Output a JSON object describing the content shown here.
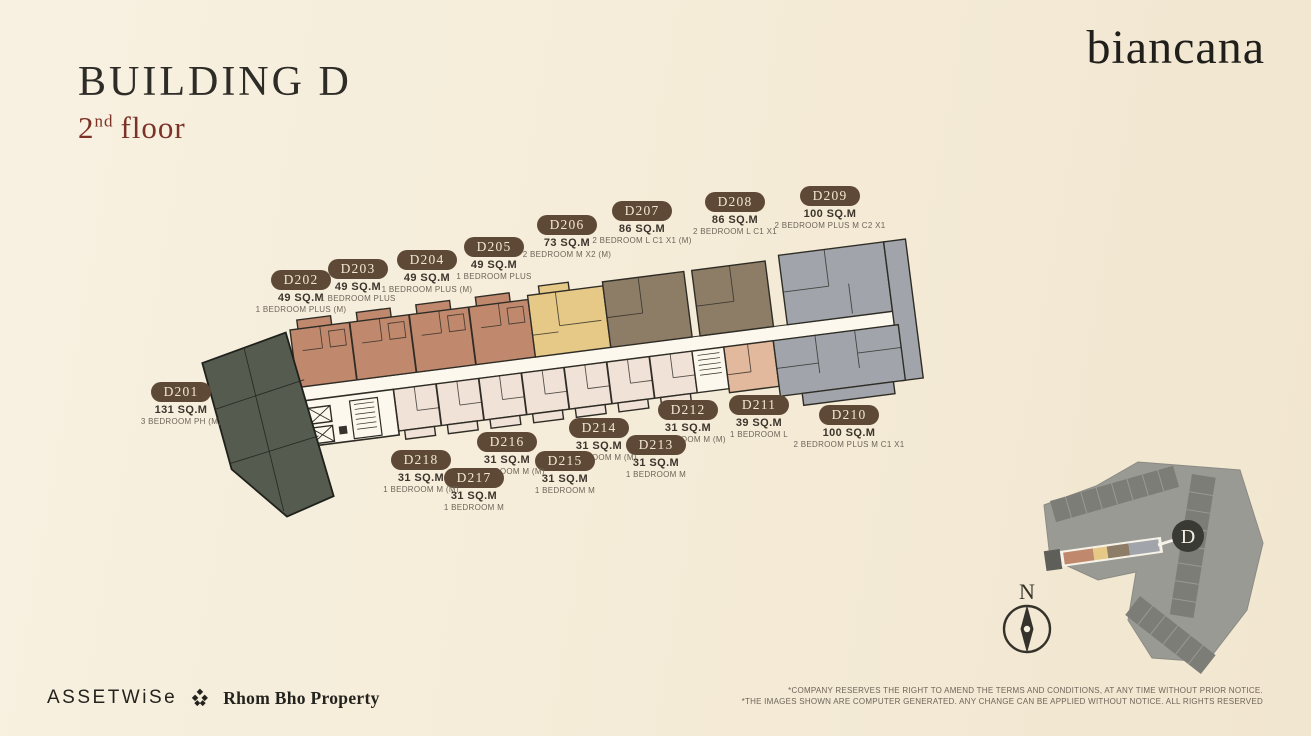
{
  "header": {
    "building_title": "BUILDING D",
    "floor_number": "2",
    "floor_ordinal": "nd",
    "floor_word": "floor"
  },
  "brand": {
    "logo_text": "biancana"
  },
  "units": [
    {
      "id": "D201",
      "area": "131 SQ.M",
      "type": "3 BEDROOM PH (M)"
    },
    {
      "id": "D202",
      "area": "49 SQ.M",
      "type": "1 BEDROOM PLUS (M)"
    },
    {
      "id": "D203",
      "area": "49 SQ.M",
      "type": "1 BEDROOM PLUS"
    },
    {
      "id": "D204",
      "area": "49 SQ.M",
      "type": "1 BEDROOM PLUS (M)"
    },
    {
      "id": "D205",
      "area": "49 SQ.M",
      "type": "1 BEDROOM PLUS"
    },
    {
      "id": "D206",
      "area": "73 SQ.M",
      "type": "2 BEDROOM M X2 (M)"
    },
    {
      "id": "D207",
      "area": "86 SQ.M",
      "type": "2 BEDROOM L C1 X1 (M)"
    },
    {
      "id": "D208",
      "area": "86 SQ.M",
      "type": "2 BEDROOM L C1 X1"
    },
    {
      "id": "D209",
      "area": "100 SQ.M",
      "type": "2 BEDROOM PLUS M C2 X1"
    },
    {
      "id": "D210",
      "area": "100 SQ.M",
      "type": "2 BEDROOM PLUS M C1 X1"
    },
    {
      "id": "D211",
      "area": "39 SQ.M",
      "type": "1 BEDROOM L"
    },
    {
      "id": "D212",
      "area": "31 SQ.M",
      "type": "1 BEDROOM M (M)"
    },
    {
      "id": "D213",
      "area": "31 SQ.M",
      "type": "1 BEDROOM M"
    },
    {
      "id": "D214",
      "area": "31 SQ.M",
      "type": "1 BEDROOM M (M)"
    },
    {
      "id": "D215",
      "area": "31 SQ.M",
      "type": "1 BEDROOM M"
    },
    {
      "id": "D216",
      "area": "31 SQ.M",
      "type": "1 BEDROOM M (M)"
    },
    {
      "id": "D217",
      "area": "31 SQ.M",
      "type": "1 BEDROOM M"
    },
    {
      "id": "D218",
      "area": "31 SQ.M",
      "type": "1 BEDROOM M (M)"
    }
  ],
  "sitemap": {
    "building_badge": "D"
  },
  "compass": {
    "north_label": "N"
  },
  "footer": {
    "assetwise_logo": "ASSETWiSe",
    "partner_logo": "Rhom Bho Property",
    "disclaimer_line1": "*COMPANY RESERVES THE RIGHT TO AMEND THE TERMS AND CONDITIONS, AT ANY TIME WITHOUT PRIOR NOTICE.",
    "disclaimer_line2": "*THE IMAGES SHOWN ARE COMPUTER GENERATED. ANY CHANGE CAN BE APPLIED WITHOUT NOTICE. ALL RIGHTS RESERVED"
  },
  "colors": {
    "unit_dark_green": "#565b50",
    "unit_salmon": "#c0896e",
    "unit_tan": "#e7c987",
    "unit_taupe": "#8d7d67",
    "unit_grey": "#a1a5ab",
    "unit_light_pink": "#f1e2d7",
    "unit_salmon_pink": "#e3b99d",
    "corridor_white": "#fcf8ee",
    "label_pill_bg": "#5e4936",
    "label_pill_text": "#f2e7d2",
    "accent_red": "#7c3227"
  }
}
